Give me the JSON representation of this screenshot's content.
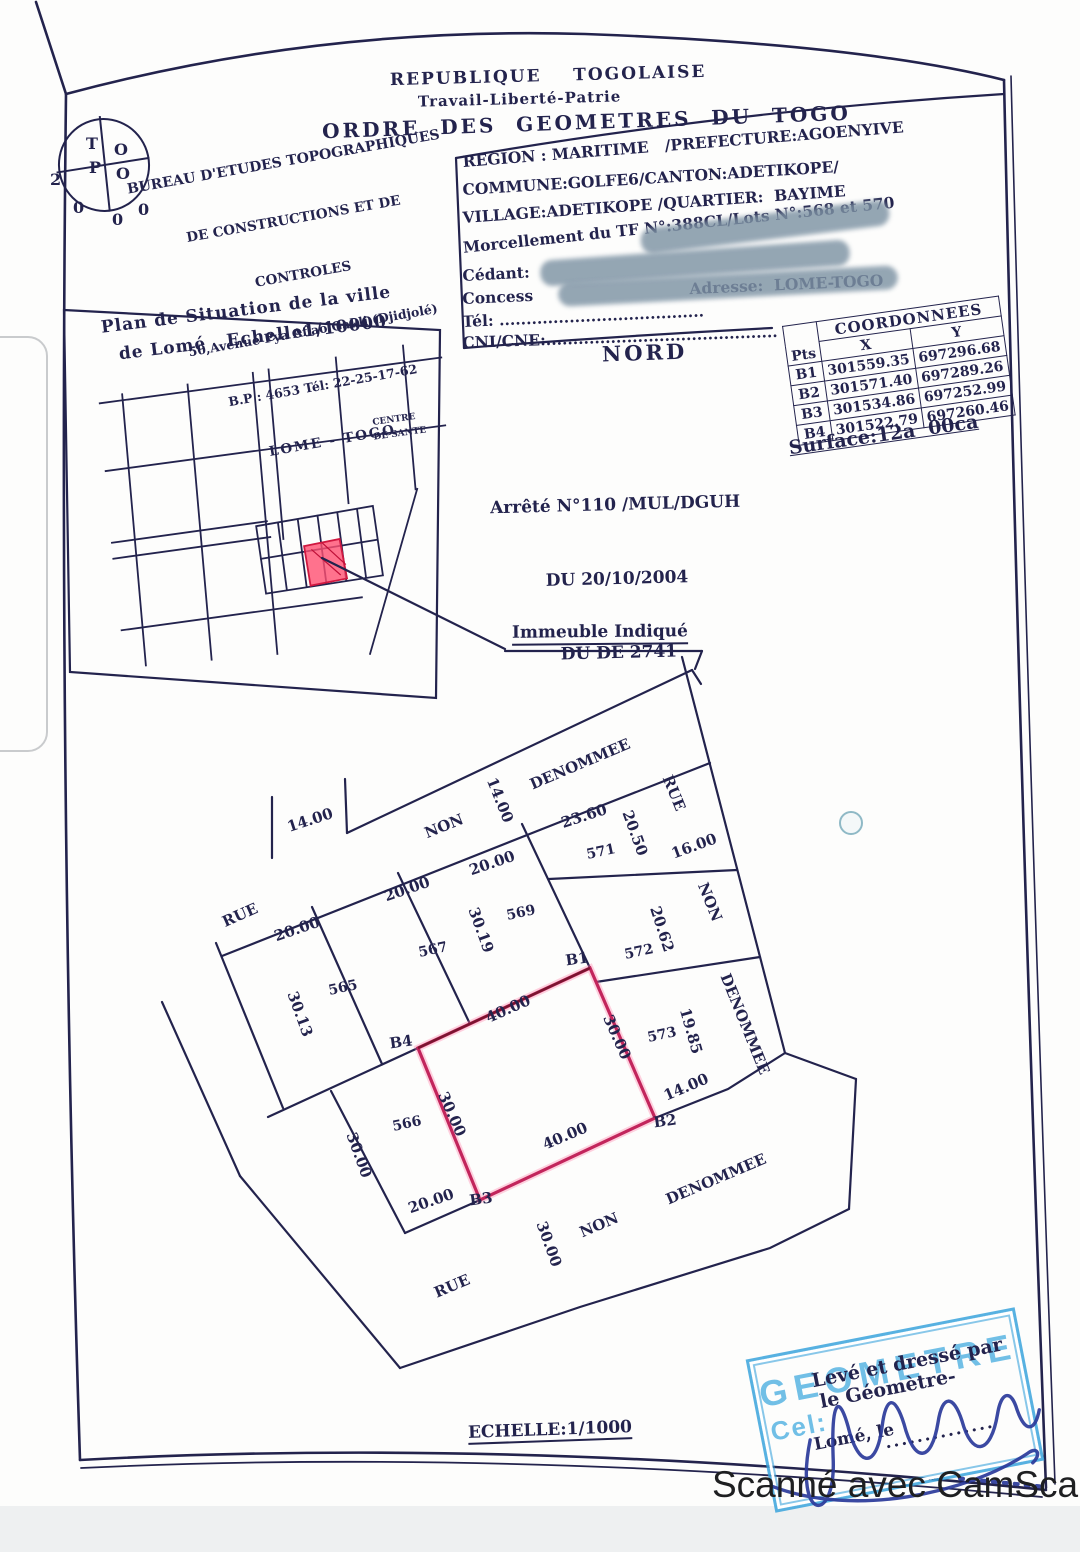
{
  "document": {
    "header": {
      "line1": "REPUBLIQUE    TOGOLAISE",
      "line2": "Travail-Liberté-Patrie",
      "line3": "ORDRE  DES  GEOMETRES  DU  TOGO"
    },
    "bureau": {
      "line1": "BUREAU D'ETUDES TOPOGRAPHIQUES",
      "line2": "DE CONSTRUCTIONS ET DE",
      "line3": "CONTROLES",
      "line4": "50,Avenue Pya Aflao Gakli (Djidjolé)",
      "line5": "B.P : 4653 Tél: 22-25-17-62",
      "line6": "LOME - TOGO",
      "logo": {
        "q1": "T",
        "q2": "O",
        "q3": "P",
        "q4": "O",
        "stray": [
          "2",
          "0",
          "0",
          "0"
        ]
      }
    },
    "info": {
      "line1": "REGION : MARITIME   /PREFECTURE:AGOENYIVE",
      "line2": "COMMUNE:GOLFE6/CANTON:ADETIKOPE/",
      "line3": "VILLAGE:ADETIKOPE /QUARTIER:  BAYIME",
      "line4": "Morcellement du TF N°:388CL/Lots N°:568 et 570",
      "line5": "Cédant:",
      "line6": "Concess                             Adresse:  LOME-TOGO",
      "line7": "Tél: ......................................",
      "line8": "CNI/CNE:..........................................."
    },
    "coordinates": {
      "title": "COORDONNEES",
      "col_pts": "Pts",
      "col_x": "X",
      "col_y": "Y",
      "rows": [
        {
          "pt": "B1",
          "x": "301559.35",
          "y": "697296.68"
        },
        {
          "pt": "B2",
          "x": "301571.40",
          "y": "697289.26"
        },
        {
          "pt": "B3",
          "x": "301534.86",
          "y": "697252.99"
        },
        {
          "pt": "B4",
          "x": "301522.79",
          "y": "697260.46"
        }
      ],
      "surface": "Surface:12a  00ca"
    },
    "north_label": "NORD",
    "arrete": {
      "line1": "Arrêté N°110 /MUL/DGUH",
      "line2": "DU 20/10/2004",
      "line3": "DU DE 2741"
    },
    "situation": {
      "title_line1": "Plan de Situation de la ville",
      "title_line2": "de Lomé   Echelle1/10000"
    },
    "immeuble_label": "Immeuble Indiqué",
    "scale_label": "ECHELLE:1/1000",
    "stamp": {
      "big": "GEOMETRE",
      "cel": "Cel:",
      "line1": "Levé et dressé par",
      "line2": "le Géomètre-",
      "line3": "Lomé, le",
      "dots": ".............."
    },
    "scanner_label": "Scanné avec CamScanner"
  },
  "plan": {
    "labels": [
      {
        "t": "RUE",
        "x": 240,
        "y": 915,
        "r": -24,
        "s": 15,
        "n": "street-label-rue-top"
      },
      {
        "t": "14.00",
        "x": 310,
        "y": 820,
        "r": -18,
        "s": 15,
        "n": "dim-14-00-top"
      },
      {
        "t": "NON",
        "x": 444,
        "y": 826,
        "r": -22,
        "s": 15,
        "n": "street-label-non-top"
      },
      {
        "t": "14.00",
        "x": 500,
        "y": 800,
        "r": 68,
        "s": 15,
        "n": "dim-14-00-street-width"
      },
      {
        "t": "DENOMMEE",
        "x": 580,
        "y": 764,
        "r": -23,
        "s": 15,
        "n": "street-label-denommee-top"
      },
      {
        "t": "RUE",
        "x": 674,
        "y": 793,
        "r": 68,
        "s": 15,
        "n": "street-label-rue-right"
      },
      {
        "t": "16.00",
        "x": 694,
        "y": 846,
        "r": -20,
        "s": 15,
        "n": "dim-16-00-right-street"
      },
      {
        "t": "NON",
        "x": 710,
        "y": 902,
        "r": 68,
        "s": 15,
        "n": "street-label-non-right"
      },
      {
        "t": "DENOMMEE",
        "x": 745,
        "y": 1024,
        "r": 68,
        "s": 15,
        "n": "street-label-denommee-right"
      },
      {
        "t": "23.60",
        "x": 584,
        "y": 816,
        "r": -18,
        "s": 15,
        "n": "dim-23-60-lot571"
      },
      {
        "t": "20.50",
        "x": 635,
        "y": 833,
        "r": 70,
        "s": 15,
        "n": "dim-20-50-lot571"
      },
      {
        "t": "571",
        "x": 601,
        "y": 852,
        "r": -12,
        "s": 14,
        "n": "lot-571"
      },
      {
        "t": "20.00",
        "x": 492,
        "y": 863,
        "r": -19,
        "s": 15,
        "n": "dim-20-00-lot569"
      },
      {
        "t": "20.00",
        "x": 407,
        "y": 889,
        "r": -19,
        "s": 15,
        "n": "dim-20-00-lot567"
      },
      {
        "t": "20.00",
        "x": 297,
        "y": 929,
        "r": -19,
        "s": 15,
        "n": "dim-20-00-lot565"
      },
      {
        "t": "30.19",
        "x": 481,
        "y": 930,
        "r": 70,
        "s": 15,
        "n": "dim-30-19-lot569"
      },
      {
        "t": "569",
        "x": 521,
        "y": 913,
        "r": -12,
        "s": 14,
        "n": "lot-569"
      },
      {
        "t": "567",
        "x": 433,
        "y": 950,
        "r": -12,
        "s": 14,
        "n": "lot-567"
      },
      {
        "t": "565",
        "x": 343,
        "y": 988,
        "r": -12,
        "s": 14,
        "n": "lot-565"
      },
      {
        "t": "30.13",
        "x": 300,
        "y": 1014,
        "r": 70,
        "s": 15,
        "n": "dim-30-13-lot565"
      },
      {
        "t": "572",
        "x": 639,
        "y": 952,
        "r": -12,
        "s": 14,
        "n": "lot-572"
      },
      {
        "t": "20.62",
        "x": 662,
        "y": 929,
        "r": 72,
        "s": 15,
        "n": "dim-20-62-lot572"
      },
      {
        "t": "B1",
        "x": 577,
        "y": 959,
        "r": -8,
        "s": 15,
        "n": "corner-b1"
      },
      {
        "t": "B4",
        "x": 401,
        "y": 1042,
        "r": -8,
        "s": 15,
        "n": "corner-b4"
      },
      {
        "t": "40.00",
        "x": 508,
        "y": 1009,
        "r": -24,
        "s": 15,
        "n": "dim-40-00-top"
      },
      {
        "t": "30.00",
        "x": 617,
        "y": 1037,
        "r": 66,
        "s": 15,
        "n": "dim-30-00-right"
      },
      {
        "t": "573",
        "x": 662,
        "y": 1035,
        "r": -12,
        "s": 14,
        "n": "lot-573"
      },
      {
        "t": "19.85",
        "x": 691,
        "y": 1031,
        "r": 74,
        "s": 15,
        "n": "dim-19-85-lot573"
      },
      {
        "t": "30.00",
        "x": 452,
        "y": 1114,
        "r": 66,
        "s": 15,
        "n": "dim-30-00-left"
      },
      {
        "t": "566",
        "x": 407,
        "y": 1124,
        "r": -12,
        "s": 14,
        "n": "lot-566"
      },
      {
        "t": "30.00",
        "x": 359,
        "y": 1155,
        "r": 70,
        "s": 15,
        "n": "dim-30-00-lot566"
      },
      {
        "t": "14.00",
        "x": 686,
        "y": 1087,
        "r": -23,
        "s": 15,
        "n": "dim-14-00-b2"
      },
      {
        "t": "B2",
        "x": 665,
        "y": 1121,
        "r": -8,
        "s": 15,
        "n": "corner-b2"
      },
      {
        "t": "40.00",
        "x": 565,
        "y": 1136,
        "r": -23,
        "s": 15,
        "n": "dim-40-00-bottom"
      },
      {
        "t": "20.00",
        "x": 431,
        "y": 1201,
        "r": -19,
        "s": 15,
        "n": "dim-20-00-lot566-bottom"
      },
      {
        "t": "B3",
        "x": 481,
        "y": 1199,
        "r": -8,
        "s": 15,
        "n": "corner-b3"
      },
      {
        "t": "30.00",
        "x": 549,
        "y": 1244,
        "r": 70,
        "s": 15,
        "n": "dim-30-00-bottom-street"
      },
      {
        "t": "NON",
        "x": 599,
        "y": 1225,
        "r": -23,
        "s": 15,
        "n": "street-label-non-bottom"
      },
      {
        "t": "DENOMMEE",
        "x": 716,
        "y": 1179,
        "r": -23,
        "s": 15,
        "n": "street-label-denommee-bottom"
      },
      {
        "t": "RUE",
        "x": 452,
        "y": 1286,
        "r": -23,
        "s": 15,
        "n": "street-label-rue-bottom"
      },
      {
        "t": "CENTRE",
        "x": 394,
        "y": 420,
        "r": -8,
        "s": 9,
        "n": "map-label-centre"
      },
      {
        "t": "DE  SANTE",
        "x": 400,
        "y": 434,
        "r": -8,
        "s": 9,
        "n": "map-label-de-sante"
      }
    ]
  },
  "colors": {
    "ink": "#23234d",
    "parcel_red": "#c2255c",
    "parcel_dark": "#7a1430",
    "inset_red": "#ff4f70",
    "stamp_blue": "#35a3dc",
    "signature_blue": "#2b3a9b",
    "scanner_text": "#1e1f21",
    "footer_strip": "#eef0f1"
  }
}
